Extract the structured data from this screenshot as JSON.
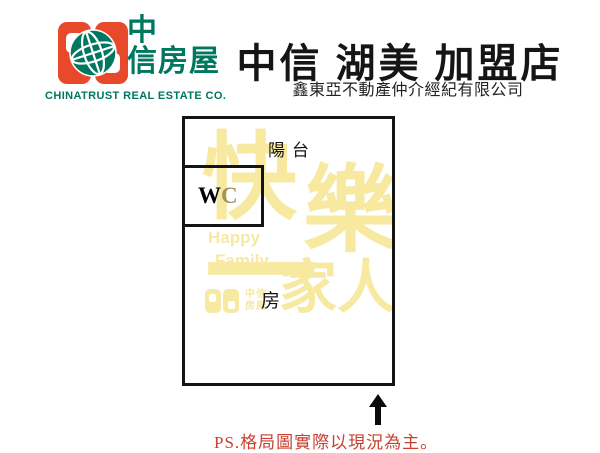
{
  "header": {
    "logo": {
      "brand_cn_line1": "中",
      "brand_cn_line2": "信房屋",
      "brand_en": "CHINATRUST REAL ESTATE CO.",
      "colors": {
        "orange": "#e8492b",
        "teal": "#00775f"
      }
    },
    "title": "中信 湖美 加盟店",
    "subtitle": "鑫東亞不動產仲介經紀有限公司"
  },
  "floorplan": {
    "labels": {
      "balcony": "陽台",
      "wc_w": "W",
      "wc_c": "C",
      "room": "房"
    },
    "watermark": {
      "char_kuai": "快",
      "char_le": "樂",
      "char_yi": "一",
      "chars_jiaren": "家人",
      "en_line1": "Happy",
      "en_line2": "Family",
      "mini_logo_text": "中信 房屋",
      "color": "#f7e9a0"
    },
    "wall_color": "#141414"
  },
  "footer": {
    "note": "PS.格局圖實際以現況為主。",
    "note_color": "#c8402f"
  }
}
